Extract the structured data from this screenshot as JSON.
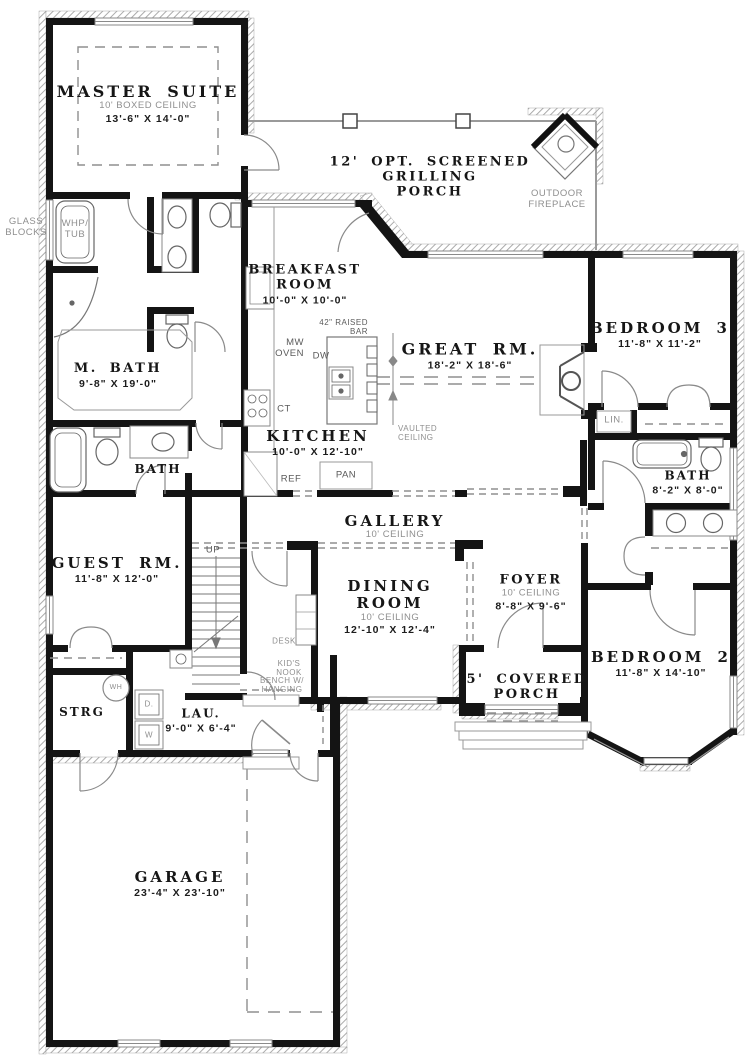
{
  "plan": {
    "colors": {
      "wall": "#141414",
      "annotation_gray": "#8f8f8f",
      "fixture": "#666666"
    },
    "rooms": {
      "master_suite": {
        "name": "MASTER SUITE",
        "ceiling": "10' BOXED CEILING",
        "dims": "13'-6\" X 14'-0\""
      },
      "grilling_porch": {
        "line1": "12' OPT. SCREENED",
        "line2": "GRILLING",
        "line3": "PORCH"
      },
      "breakfast": {
        "line1": "BREAKFAST",
        "line2": "ROOM",
        "dims": "10'-0\" X 10'-0\""
      },
      "great_rm": {
        "name": "GREAT RM.",
        "dims": "18'-2\" X 18'-6\""
      },
      "bedroom3": {
        "name": "BEDROOM 3",
        "dims": "11'-8\" X 11'-2\""
      },
      "m_bath": {
        "name": "M. BATH",
        "dims": "9'-8\" X 19'-0\""
      },
      "kitchen": {
        "name": "KITCHEN",
        "dims": "10'-0\" X 12'-10\""
      },
      "bath1": {
        "name": "BATH"
      },
      "bath2": {
        "name": "BATH",
        "dims": "8'-2\" X 8'-0\""
      },
      "gallery": {
        "name": "GALLERY",
        "ceiling": "10' CEILING"
      },
      "dining": {
        "line1": "DINING",
        "line2": "ROOM",
        "ceiling": "10' CEILING",
        "dims": "12'-10\" X 12'-4\""
      },
      "foyer": {
        "name": "FOYER",
        "ceiling": "10' CEILING",
        "dims": "8'-8\" X 9'-6\""
      },
      "guest": {
        "name": "GUEST RM.",
        "dims": "11'-8\" X 12'-0\""
      },
      "bedroom2": {
        "name": "BEDROOM 2",
        "dims": "11'-8\" X 14'-10\""
      },
      "covered_porch": {
        "line1": "5' COVERED",
        "line2": "PORCH"
      },
      "strg": {
        "name": "STRG"
      },
      "lau": {
        "name": "LAU.",
        "dims": "9'-0\" X 6'-4\""
      },
      "garage": {
        "name": "GARAGE",
        "dims": "23'-4\" X 23'-10\""
      }
    },
    "annotations": {
      "outdoor_fireplace": {
        "line1": "OUTDOOR",
        "line2": "FIREPLACE"
      },
      "glass_blocks": {
        "line1": "GLASS",
        "line2": "BLOCKS"
      },
      "whp_tub": {
        "line1": "WHP/",
        "line2": "TUB"
      },
      "raised_bar": {
        "line1": "42\" RAISED",
        "line2": "BAR"
      },
      "mw_oven": {
        "line1": "MW",
        "line2": "OVEN"
      },
      "dw": "DW",
      "ct": "CT",
      "ref": "REF",
      "pan": "PAN",
      "vaulted_ceiling": {
        "line1": "VAULTED",
        "line2": "CEILING"
      },
      "lin": "LIN.",
      "up": "UP",
      "desk": "DESK",
      "kids_nook": {
        "line1": "KID'S",
        "line2": "NOOK"
      },
      "bench": {
        "line1": "BENCH W/",
        "line2": "HANGING"
      },
      "wh": "WH",
      "d": "D.",
      "w": "W"
    }
  }
}
